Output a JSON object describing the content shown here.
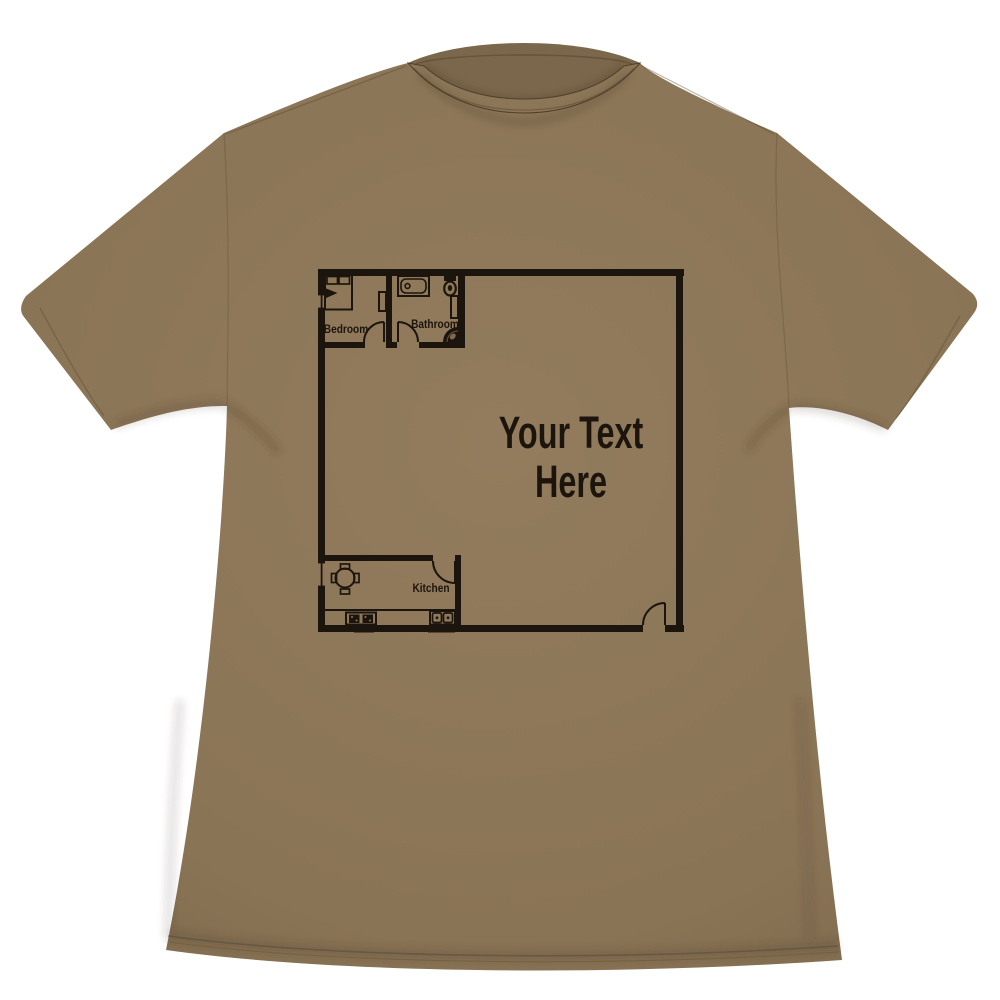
{
  "scene": {
    "subject": "t-shirt-product-photo"
  },
  "colors": {
    "background": "#ffffff",
    "shirt_base": "#8c7658",
    "shirt_edge_shadow": "#7c684c",
    "collar_inner": "#7b674b",
    "stitch": "#55452f",
    "print": "#17100a"
  },
  "floor_plan": {
    "rooms": [
      {
        "label": "Bedroom",
        "fixtures": [
          "bed",
          "pillows",
          "dresser",
          "window",
          "door-swing"
        ]
      },
      {
        "label": "Bathroom",
        "fixtures": [
          "bathtub",
          "toilet",
          "vanity",
          "corner-sink",
          "door-swing"
        ]
      },
      {
        "label": "Kitchen",
        "fixtures": [
          "round-table",
          "four-chairs",
          "counter",
          "stove",
          "double-sink",
          "window",
          "door-swing"
        ]
      }
    ],
    "main_room": {
      "text_line1": "Your Text",
      "text_line2": "Here",
      "entry": "front-door-swing"
    }
  }
}
